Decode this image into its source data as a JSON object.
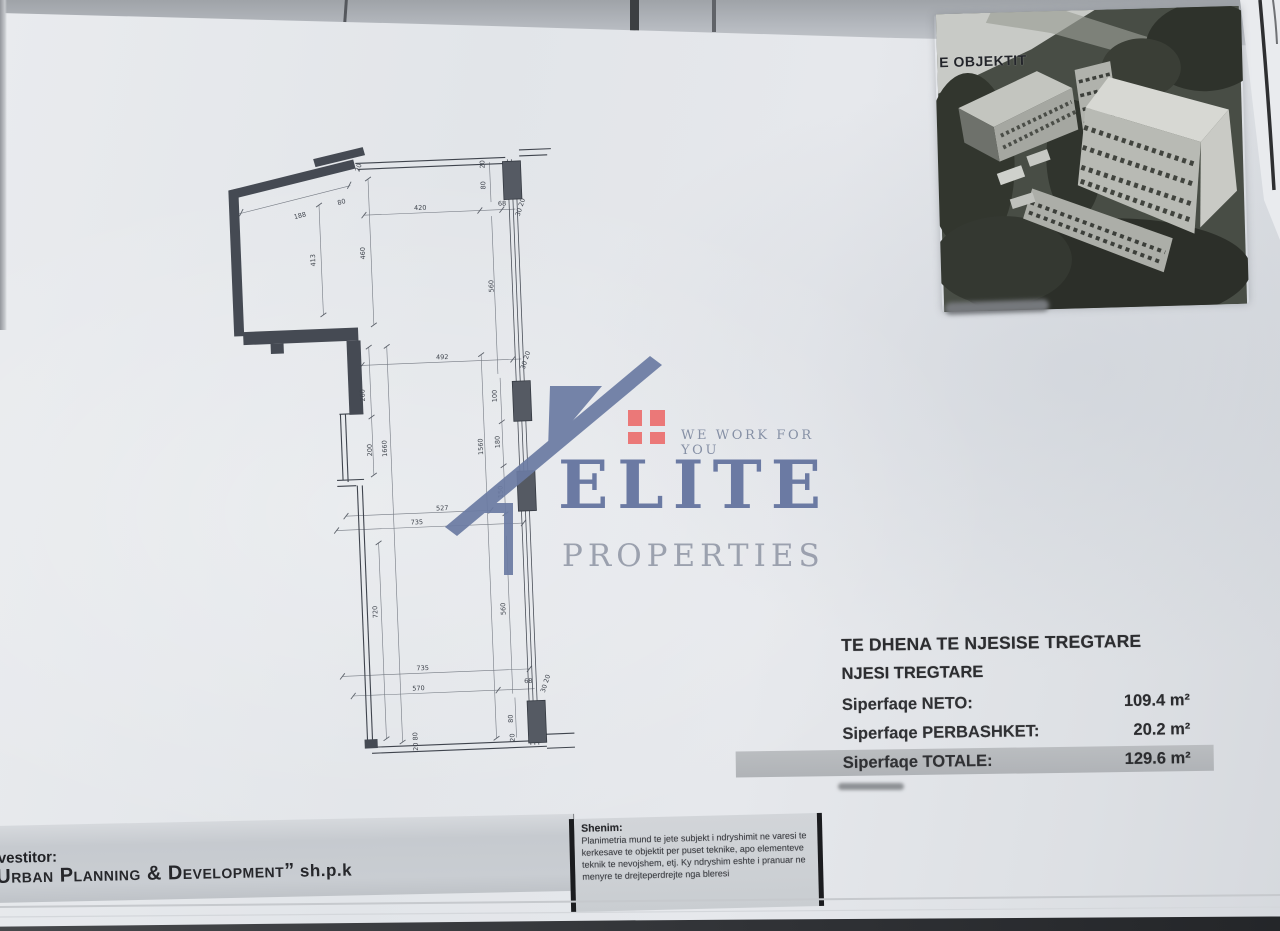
{
  "photo": {
    "label": "E OBJEKTIT"
  },
  "logo": {
    "tagline": "WE WORK FOR YOU",
    "name": "ELITE",
    "subname": "PROPERTIES",
    "accent_color": "#ec6f6f",
    "brand_color": "#61719d"
  },
  "data_table": {
    "title": "TE DHENA TE NJESISE TREGTARE",
    "subtitle": "NJESI TREGTARE",
    "rows": [
      {
        "label": "Siperfaqe NETO:",
        "value": "109.4 m²",
        "highlight": false
      },
      {
        "label": "Siperfaqe PERBASHKET:",
        "value": "20.2 m²",
        "highlight": false
      },
      {
        "label": "Siperfaqe TOTALE:",
        "value": "129.6 m²",
        "highlight": true
      }
    ],
    "highlight_color": "#b5b8bb"
  },
  "investor": {
    "prefix": "vestitor:",
    "company": "Urban Planning & Development”",
    "suffix": " sh.p.k"
  },
  "note": {
    "title": "Shenim:",
    "body": "Planimetria mund te jete subjekt i ndryshimit ne varesi te kerkesave te objektit per puset teknike, apo elementeve teknik te nevojshem, etj. Ky ndryshim eshte i pranuar ne menyre te drejteperdrejte nga bleresi"
  },
  "plan": {
    "labels": [
      {
        "t": "20",
        "x": 139,
        "y": 27,
        "r": -70
      },
      {
        "t": "188",
        "x": 77,
        "y": 74,
        "r": -12
      },
      {
        "t": "80",
        "x": 119,
        "y": 62,
        "r": -12
      },
      {
        "t": "413",
        "x": 90,
        "y": 117,
        "r": -90
      },
      {
        "t": "460",
        "x": 140,
        "y": 112,
        "r": -90
      },
      {
        "t": "420",
        "x": 197,
        "y": 71,
        "r": 0
      },
      {
        "t": "68",
        "x": 279,
        "y": 70,
        "r": 0
      },
      {
        "t": "30 20",
        "x": 299,
        "y": 73,
        "r": -70
      },
      {
        "t": "20",
        "x": 263,
        "y": 28,
        "r": -90
      },
      {
        "t": "80",
        "x": 263,
        "y": 49,
        "r": -90
      },
      {
        "t": "560",
        "x": 267,
        "y": 150,
        "r": -90
      },
      {
        "t": "492",
        "x": 213,
        "y": 221,
        "r": 0
      },
      {
        "t": "30 20",
        "x": 298,
        "y": 226,
        "r": -70
      },
      {
        "t": "260",
        "x": 134,
        "y": 254,
        "r": -90
      },
      {
        "t": "200",
        "x": 139,
        "y": 309,
        "r": -90
      },
      {
        "t": "1660",
        "x": 154,
        "y": 308,
        "r": -90
      },
      {
        "t": "1560",
        "x": 250,
        "y": 310,
        "r": -90
      },
      {
        "t": "100",
        "x": 266,
        "y": 260,
        "r": -90
      },
      {
        "t": "180",
        "x": 267,
        "y": 306,
        "r": -90
      },
      {
        "t": "150",
        "x": 268,
        "y": 356,
        "r": -90
      },
      {
        "t": "527",
        "x": 207,
        "y": 372,
        "r": 0
      },
      {
        "t": "735",
        "x": 181,
        "y": 385,
        "r": 0
      },
      {
        "t": "720",
        "x": 138,
        "y": 471,
        "r": -90
      },
      {
        "t": "560",
        "x": 266,
        "y": 473,
        "r": -90
      },
      {
        "t": "735",
        "x": 181,
        "y": 531,
        "r": 0
      },
      {
        "t": "570",
        "x": 176,
        "y": 551,
        "r": 0
      },
      {
        "t": "68",
        "x": 286,
        "y": 548,
        "r": 0
      },
      {
        "t": "30 20",
        "x": 305,
        "y": 550,
        "r": -70
      },
      {
        "t": "80",
        "x": 269,
        "y": 583,
        "r": -90
      },
      {
        "t": "20",
        "x": 270,
        "y": 602,
        "r": -90
      },
      {
        "t": "20 80",
        "x": 173,
        "y": 602,
        "r": -90
      }
    ]
  }
}
